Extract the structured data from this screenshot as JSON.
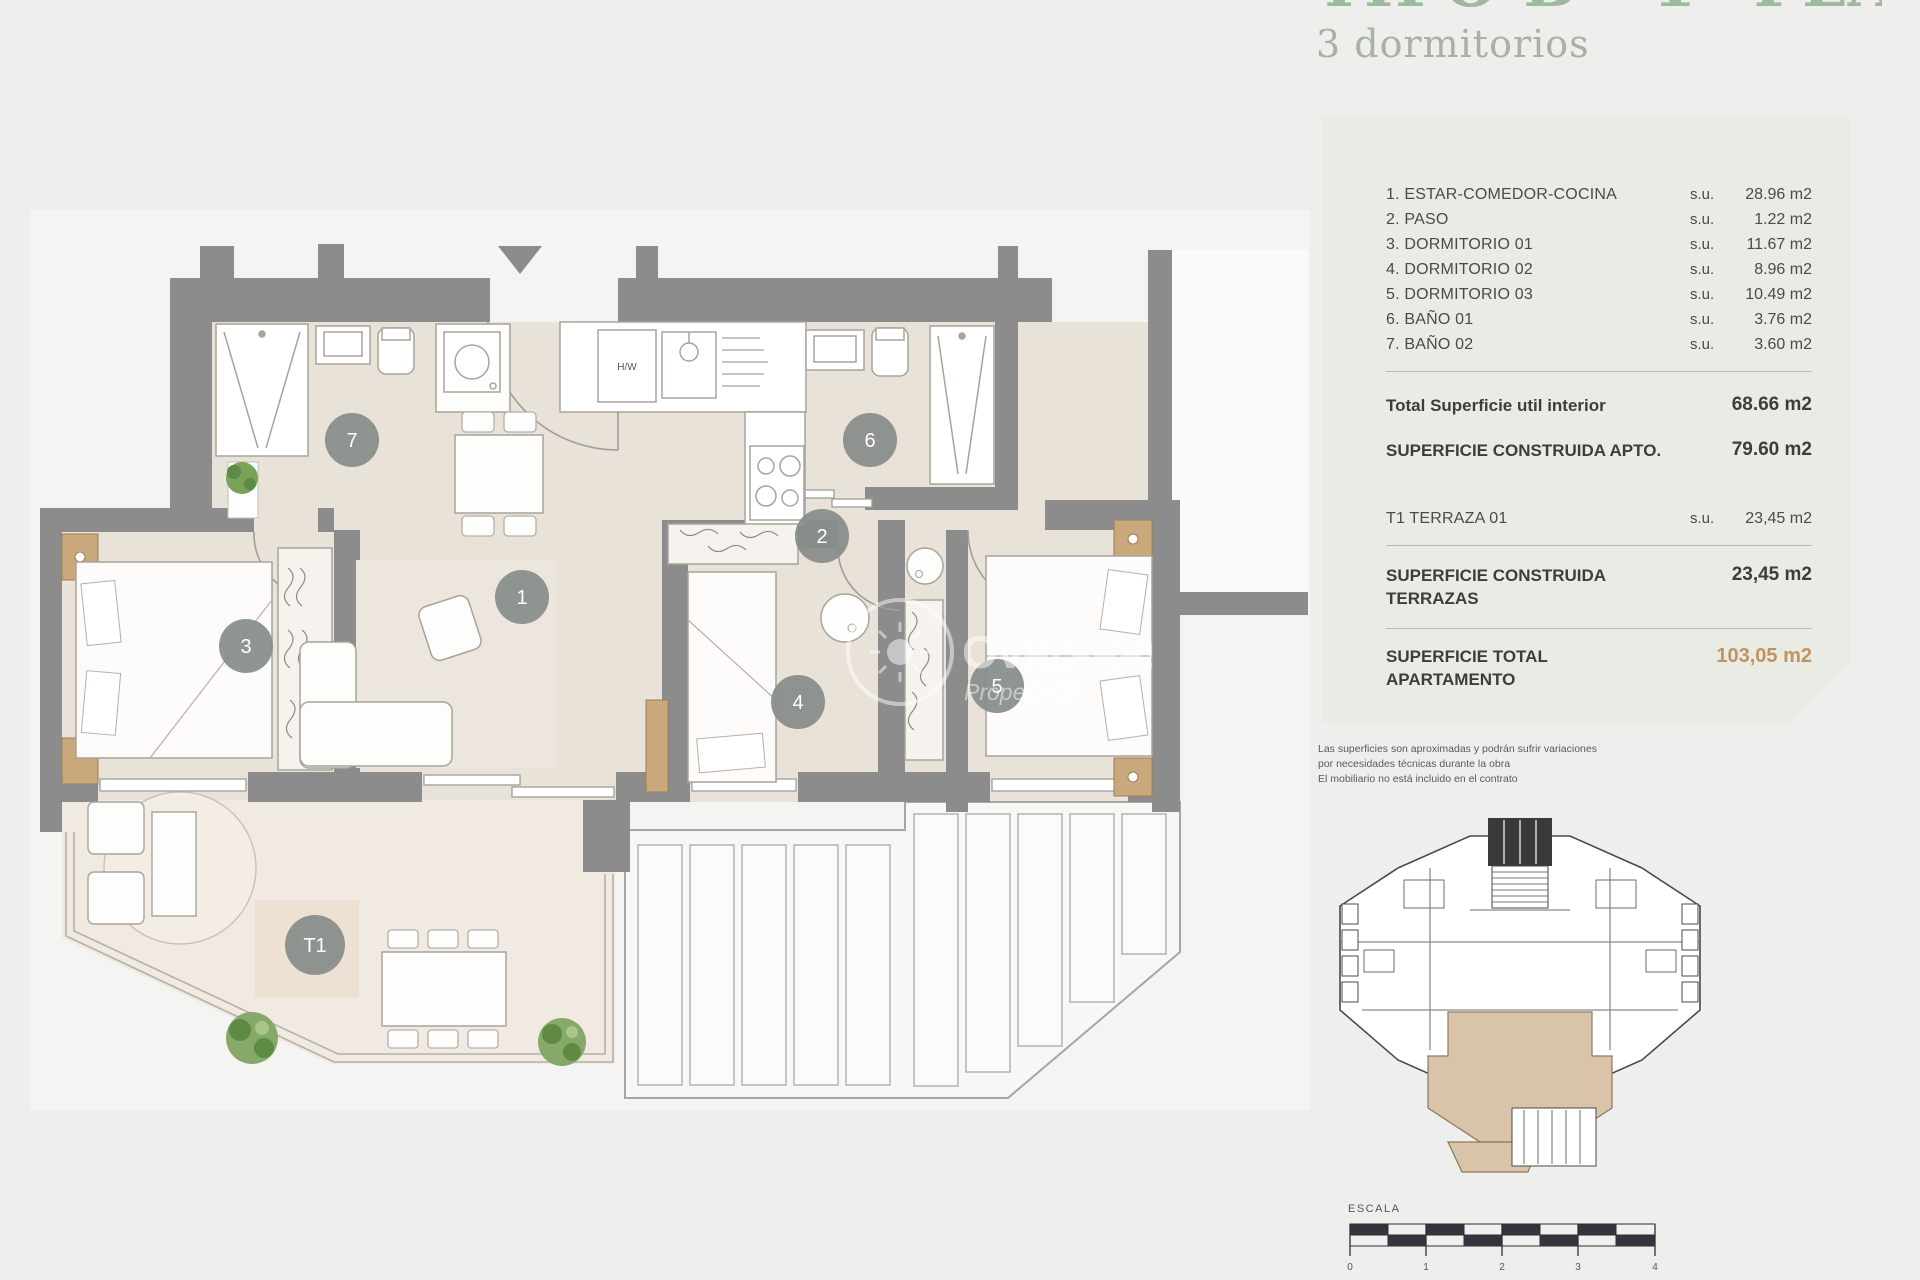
{
  "header": {
    "title_clipped": "TIPO B - 1ª PLANTA",
    "subtitle": "3 dormitorios"
  },
  "panel": {
    "rooms": [
      {
        "label": "1. ESTAR-COMEDOR-COCINA",
        "unit": "s.u.",
        "area": "28.96 m2"
      },
      {
        "label": "2. PASO",
        "unit": "s.u.",
        "area": "1.22 m2"
      },
      {
        "label": "3. DORMITORIO 01",
        "unit": "s.u.",
        "area": "11.67 m2"
      },
      {
        "label": "4. DORMITORIO 02",
        "unit": "s.u.",
        "area": "8.96 m2"
      },
      {
        "label": "5. DORMITORIO 03",
        "unit": "s.u.",
        "area": "10.49 m2"
      },
      {
        "label": "6. BAÑO 01",
        "unit": "s.u.",
        "area": "3.76 m2"
      },
      {
        "label": "7. BAÑO 02",
        "unit": "s.u.",
        "area": "3.60 m2"
      }
    ],
    "total_util": {
      "label": "Total Superficie util interior",
      "area": "68.66 m2"
    },
    "constructed": {
      "label": "SUPERFICIE CONSTRUIDA APTO.",
      "area": "79.60 m2"
    },
    "terrace_row": {
      "label": "T1 TERRAZA 01",
      "unit": "s.u.",
      "area": "23,45 m2"
    },
    "constructed_terraces": {
      "label_line1": "SUPERFICIE CONSTRUIDA",
      "label_line2": "TERRAZAS",
      "area": "23,45 m2"
    },
    "total": {
      "label_line1": "SUPERFICIE TOTAL",
      "label_line2": "APARTAMENTO",
      "area": "103,05 m2"
    }
  },
  "disclaimer": {
    "line1": "Las superficies son aproximadas y podrán sufrir variaciones",
    "line2": "por necesidades técnicas durante la obra",
    "line3": "El mobiliario no está incluido en el contrato"
  },
  "plan": {
    "markers": {
      "m1": "1",
      "m2": "2",
      "m3": "3",
      "m4": "4",
      "m5": "5",
      "m6": "6",
      "m7": "7",
      "t1": "T1"
    },
    "labels": {
      "hw": "H/W"
    },
    "watermark": {
      "line1": "Overseas",
      "line2": "Property N"
    }
  },
  "scale": {
    "label": "ESCALA",
    "ticks": [
      "0",
      "1",
      "2",
      "3",
      "4"
    ]
  },
  "colors": {
    "wall": "#8c8c8c",
    "floor": "#e9e2d9",
    "terrace": "#f1eae2",
    "panel": "#e9ece5",
    "accent_tan": "#c2935f",
    "highlight": "#d9c3a9",
    "green_title": "#9dbb9c"
  }
}
